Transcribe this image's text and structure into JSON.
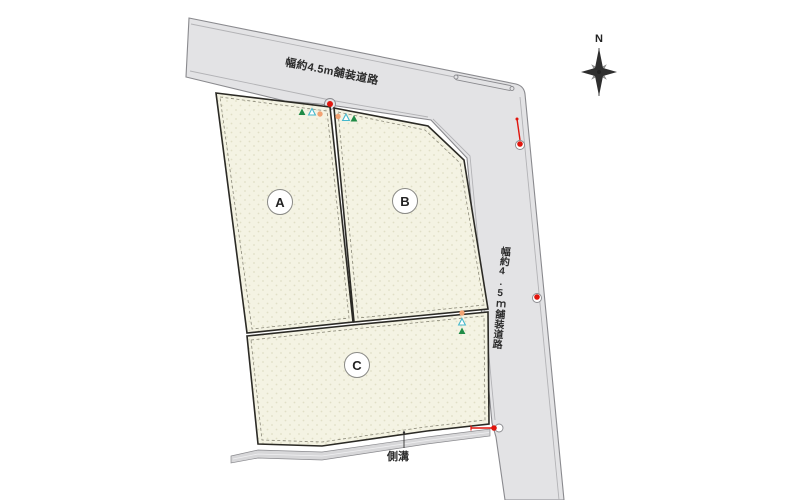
{
  "title": "区画図",
  "compass": {
    "label": "N"
  },
  "roads": {
    "top": {
      "label": "幅約4.5m舗装道路"
    },
    "right": {
      "label": "幅約4.5ｍ舗装道路"
    }
  },
  "plots": {
    "a": {
      "label": "A"
    },
    "b": {
      "label": "B"
    },
    "c": {
      "label": "C"
    }
  },
  "gutter": {
    "label": "側溝"
  },
  "markers": {
    "types": [
      "green-triangle",
      "open-triangle",
      "orange-dot",
      "red-utility-pole-dot"
    ]
  },
  "colors": {
    "road_fill": "#e3e3e5",
    "road_edge": "#8a8a8e",
    "road_inner_line": "#b3b3b6",
    "plot_fill": "#f4f3e3",
    "plot_dot": "#e0dfc6",
    "plot_border": "#2b2a25",
    "plot_dash": "#8a8878",
    "gutter_fill": "#d7d7d9",
    "pole_red": "#e0150d",
    "marker_green": "#1f8b46",
    "marker_cyan": "#45b8cc",
    "marker_orange": "#f2a272",
    "compass_dark": "#2e2e2e",
    "compass_light": "#8a8a8a"
  }
}
